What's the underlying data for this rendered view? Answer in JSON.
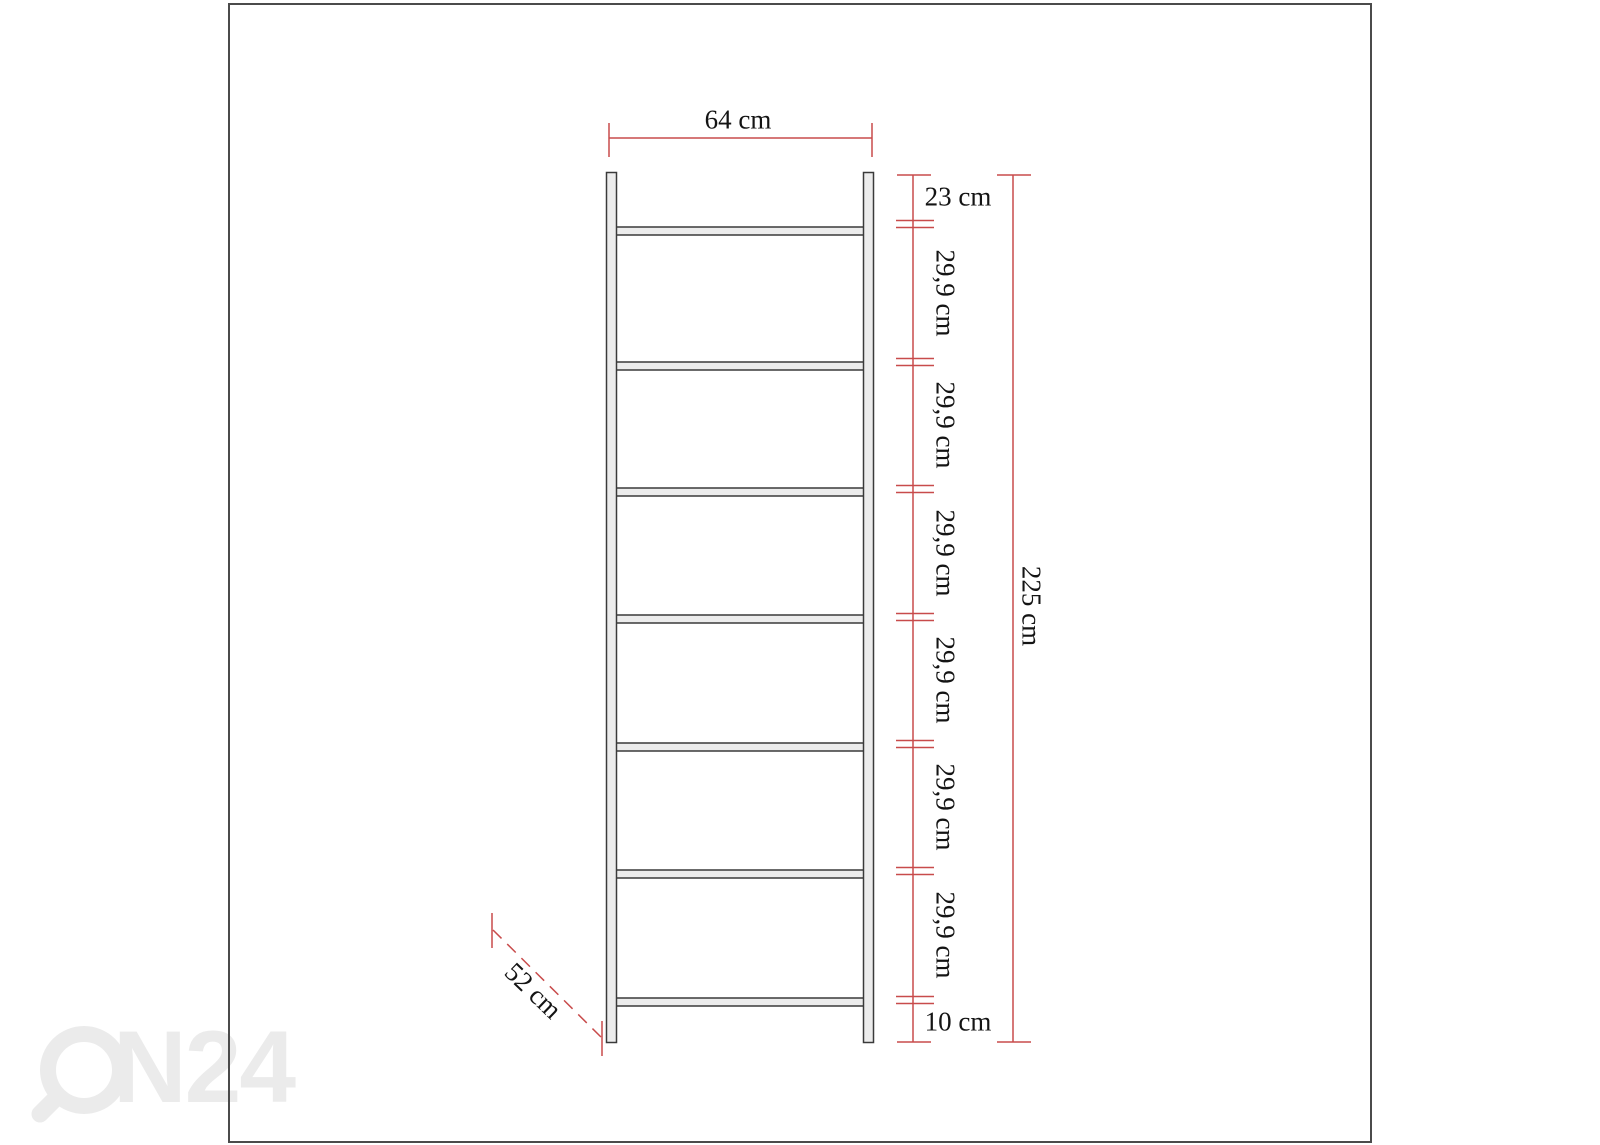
{
  "watermark": {
    "brand": "ON24",
    "visible_text": "N24"
  },
  "dimensions": {
    "width_label": "64 cm",
    "depth_label": "52 cm",
    "total_height_label": "225 cm",
    "top_gap_label": "23 cm",
    "bottom_gap_label": "10 cm",
    "segments": [
      "29,9 cm",
      "29,9 cm",
      "29,9 cm",
      "29,9 cm",
      "29,9 cm",
      "29,9 cm"
    ]
  },
  "structure": {
    "shelves": 7,
    "side_rails": 2
  },
  "colors": {
    "dimension_line": "#c84b4b",
    "drawing_line": "#3a3a3a",
    "panel_fill": "#ececec",
    "watermark": "#ebebeb",
    "frame_border": "#4b4b4b"
  }
}
